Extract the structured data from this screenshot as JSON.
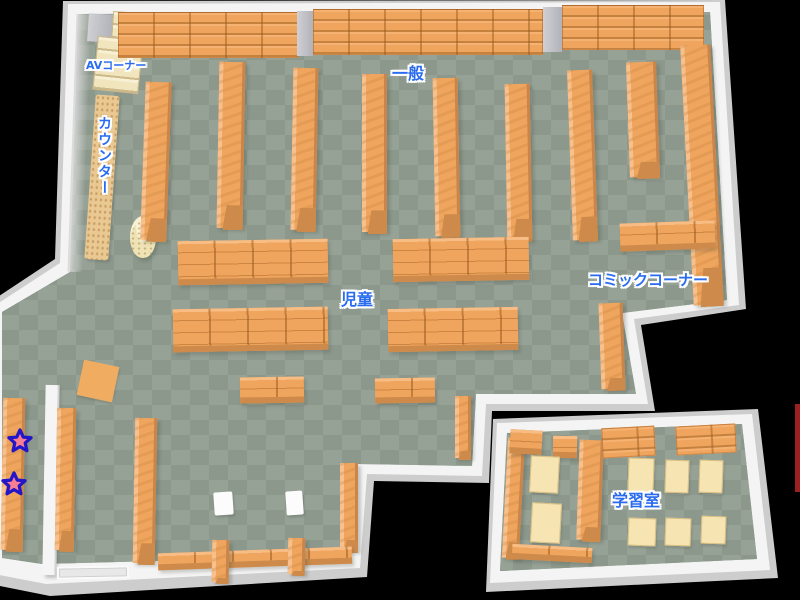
{
  "labels": {
    "av_corner": "AVコーナー",
    "general": "一般",
    "counter": "カウンター",
    "children": "児童",
    "comic_corner": "コミックコーナー",
    "study_room": "学習室"
  },
  "colors": {
    "wall": "#f4f4f4",
    "wall_shadow": "#cdcdcd",
    "wall_face": "#dadada",
    "floor_light": "#97a297",
    "floor_dark": "#8c988c",
    "shelf": "#efa55e",
    "shelf_line": "#c9854a",
    "shelf_front": "#cd8a4a",
    "counter_tan": "#eac892",
    "desk": "#f6e4b2",
    "desk_edge": "#d9bf84",
    "divider_white": "#f5f5f5",
    "stool_white": "#fcfcfc",
    "doorway_gray": "#e8e8e8",
    "mat_orange": "#f0ad62",
    "label_blue": "#2a6cf0",
    "star_fill": "#f87f92",
    "star_outline": "#2316c8",
    "map_edge_red": "#9c2020"
  },
  "markers": [
    {
      "icon": "star-icon",
      "x": 7,
      "y": 428
    },
    {
      "icon": "star-icon",
      "x": 1,
      "y": 471
    }
  ],
  "edge_strip": {
    "x": 795,
    "y": 404,
    "w": 5,
    "h": 88
  },
  "furniture": [
    {
      "name": "corner-block",
      "type": "pillar",
      "x": 88,
      "y": 14,
      "w": 24,
      "h": 28,
      "rot": 4
    },
    {
      "name": "av-shelf",
      "type": "creamShelf",
      "x": 112,
      "y": 12,
      "w": 30,
      "h": 30,
      "rot": 4
    },
    {
      "name": "av-shelf",
      "type": "creamShelf",
      "x": 95,
      "y": 38,
      "w": 46,
      "h": 54,
      "rot": 6
    },
    {
      "name": "wall-shelf-row",
      "type": "shelfTop",
      "x": 118,
      "y": 12,
      "w": 180,
      "h": 46,
      "rot": 0
    },
    {
      "name": "wall-pillar",
      "type": "pillar",
      "x": 297,
      "y": 11,
      "w": 16,
      "h": 45,
      "rot": 0
    },
    {
      "name": "wall-shelf-row",
      "type": "shelfTop",
      "x": 313,
      "y": 9,
      "w": 230,
      "h": 46,
      "rot": 0
    },
    {
      "name": "wall-pillar",
      "type": "pillar",
      "x": 543,
      "y": 7,
      "w": 19,
      "h": 45,
      "rot": 0
    },
    {
      "name": "wall-shelf-row",
      "type": "shelfTop",
      "x": 562,
      "y": 5,
      "w": 142,
      "h": 45,
      "rot": 0
    },
    {
      "name": "wall-inner-face",
      "type": "wallface",
      "x": 72,
      "y": 14,
      "w": 15,
      "h": 258,
      "rot": 2
    },
    {
      "name": "counter-desk",
      "type": "counter",
      "x": 90,
      "y": 95,
      "w": 24,
      "h": 165,
      "rot": 4
    },
    {
      "name": "round-pillar",
      "type": "cylinder",
      "x": 130,
      "y": 216,
      "w": 26,
      "h": 42,
      "rot": 0
    },
    {
      "name": "bookshelf",
      "type": "shelfV",
      "x": 143,
      "y": 82,
      "w": 26,
      "h": 158,
      "rot": 2
    },
    {
      "name": "bookshelf",
      "type": "shelfV",
      "x": 218,
      "y": 62,
      "w": 26,
      "h": 166,
      "rot": 1
    },
    {
      "name": "bookshelf",
      "type": "shelfV",
      "x": 292,
      "y": 68,
      "w": 25,
      "h": 162,
      "rot": 1
    },
    {
      "name": "bookshelf",
      "type": "shelfV",
      "x": 362,
      "y": 74,
      "w": 25,
      "h": 158,
      "rot": 0
    },
    {
      "name": "bookshelf",
      "type": "shelfV",
      "x": 434,
      "y": 78,
      "w": 25,
      "h": 158,
      "rot": -1
    },
    {
      "name": "bookshelf",
      "type": "shelfV",
      "x": 506,
      "y": 84,
      "w": 25,
      "h": 156,
      "rot": -1
    },
    {
      "name": "bookshelf",
      "type": "shelfV",
      "x": 570,
      "y": 70,
      "w": 25,
      "h": 170,
      "rot": -2
    },
    {
      "name": "bookshelf",
      "type": "shelfV",
      "x": 628,
      "y": 62,
      "w": 30,
      "h": 115,
      "rot": -2
    },
    {
      "name": "bookshelf",
      "type": "shelfV",
      "x": 687,
      "y": 45,
      "w": 30,
      "h": 260,
      "rot": -3
    },
    {
      "name": "comic-shelf",
      "type": "shelfH",
      "x": 620,
      "y": 222,
      "w": 95,
      "h": 28,
      "rot": -2
    },
    {
      "name": "bookshelf",
      "type": "shelfV",
      "x": 600,
      "y": 303,
      "w": 24,
      "h": 86,
      "rot": -2
    },
    {
      "name": "kids-shelf",
      "type": "shelfH",
      "x": 178,
      "y": 240,
      "w": 150,
      "h": 44,
      "rot": -1
    },
    {
      "name": "kids-shelf",
      "type": "shelfH",
      "x": 393,
      "y": 238,
      "w": 136,
      "h": 43,
      "rot": -1
    },
    {
      "name": "kids-shelf",
      "type": "shelfH",
      "x": 173,
      "y": 308,
      "w": 155,
      "h": 43,
      "rot": -1
    },
    {
      "name": "kids-shelf",
      "type": "shelfH",
      "x": 388,
      "y": 308,
      "w": 130,
      "h": 43,
      "rot": -1
    },
    {
      "name": "kids-shelf",
      "type": "shelfH",
      "x": 240,
      "y": 377,
      "w": 64,
      "h": 26,
      "rot": -1
    },
    {
      "name": "kids-shelf",
      "type": "shelfH",
      "x": 375,
      "y": 378,
      "w": 60,
      "h": 25,
      "rot": -1
    },
    {
      "name": "play-mat",
      "type": "mat",
      "x": 80,
      "y": 363,
      "w": 36,
      "h": 36,
      "rot": 12
    },
    {
      "name": "bookshelf",
      "type": "shelfV",
      "x": 2,
      "y": 398,
      "w": 22,
      "h": 152,
      "rot": 1
    },
    {
      "name": "partition-wall",
      "type": "divider",
      "x": 44,
      "y": 385,
      "w": 12,
      "h": 190,
      "rot": 1
    },
    {
      "name": "bookshelf",
      "type": "shelfV",
      "x": 56,
      "y": 408,
      "w": 19,
      "h": 142,
      "rot": 1
    },
    {
      "name": "bookshelf",
      "type": "shelfV",
      "x": 134,
      "y": 418,
      "w": 22,
      "h": 145,
      "rot": 1
    },
    {
      "name": "bookshelf",
      "type": "shelfV",
      "x": 340,
      "y": 463,
      "w": 18,
      "h": 88,
      "rot": 0
    },
    {
      "name": "bookshelf",
      "type": "shelfV",
      "x": 455,
      "y": 396,
      "w": 16,
      "h": 62,
      "rot": 0
    },
    {
      "name": "entrance-doorway",
      "type": "doorway",
      "x": 57,
      "y": 566,
      "w": 72,
      "h": 13,
      "rot": -1
    },
    {
      "name": "wall-shelf-strip",
      "type": "shelfH",
      "x": 158,
      "y": 550,
      "w": 194,
      "h": 17,
      "rot": -2
    },
    {
      "name": "bookshelf",
      "type": "shelfV",
      "x": 212,
      "y": 540,
      "w": 17,
      "h": 42,
      "rot": 1
    },
    {
      "name": "bookshelf",
      "type": "shelfV",
      "x": 288,
      "y": 538,
      "w": 17,
      "h": 36,
      "rot": 1
    },
    {
      "name": "stool",
      "type": "stool",
      "x": 214,
      "y": 492,
      "w": 19,
      "h": 23,
      "rot": -4
    },
    {
      "name": "stool",
      "type": "stool",
      "x": 286,
      "y": 491,
      "w": 17,
      "h": 24,
      "rot": -4
    },
    {
      "name": "study-wall-shelf",
      "type": "shelfV",
      "x": 505,
      "y": 438,
      "w": 17,
      "h": 120,
      "rot": 3
    },
    {
      "name": "study-shelf",
      "type": "shelfH",
      "x": 510,
      "y": 430,
      "w": 32,
      "h": 24,
      "rot": 3
    },
    {
      "name": "study-shelf",
      "type": "shelfH",
      "x": 553,
      "y": 436,
      "w": 24,
      "h": 22,
      "rot": 1
    },
    {
      "name": "study-divider-shelf",
      "type": "shelfV",
      "x": 578,
      "y": 440,
      "w": 24,
      "h": 100,
      "rot": 2
    },
    {
      "name": "study-shelf-row",
      "type": "shelfTop",
      "x": 602,
      "y": 427,
      "w": 53,
      "h": 30,
      "rot": -3
    },
    {
      "name": "study-shelf-row",
      "type": "shelfTop",
      "x": 676,
      "y": 425,
      "w": 60,
      "h": 29,
      "rot": -3
    },
    {
      "name": "study-desk",
      "type": "desk",
      "x": 530,
      "y": 456,
      "w": 29,
      "h": 37,
      "rot": 3
    },
    {
      "name": "study-desk",
      "type": "desk",
      "x": 531,
      "y": 503,
      "w": 30,
      "h": 40,
      "rot": 3
    },
    {
      "name": "study-desk",
      "type": "desk",
      "x": 628,
      "y": 458,
      "w": 26,
      "h": 35,
      "rot": 2
    },
    {
      "name": "study-desk",
      "type": "desk",
      "x": 665,
      "y": 460,
      "w": 24,
      "h": 33,
      "rot": 2
    },
    {
      "name": "study-desk",
      "type": "desk",
      "x": 699,
      "y": 460,
      "w": 24,
      "h": 33,
      "rot": 2
    },
    {
      "name": "study-desk",
      "type": "desk",
      "x": 628,
      "y": 518,
      "w": 28,
      "h": 28,
      "rot": 2
    },
    {
      "name": "study-desk",
      "type": "desk",
      "x": 665,
      "y": 518,
      "w": 26,
      "h": 28,
      "rot": 2
    },
    {
      "name": "study-desk",
      "type": "desk",
      "x": 701,
      "y": 516,
      "w": 25,
      "h": 28,
      "rot": 2
    },
    {
      "name": "study-wall-strip",
      "type": "shelfH",
      "x": 512,
      "y": 546,
      "w": 80,
      "h": 15,
      "rot": 3
    }
  ]
}
